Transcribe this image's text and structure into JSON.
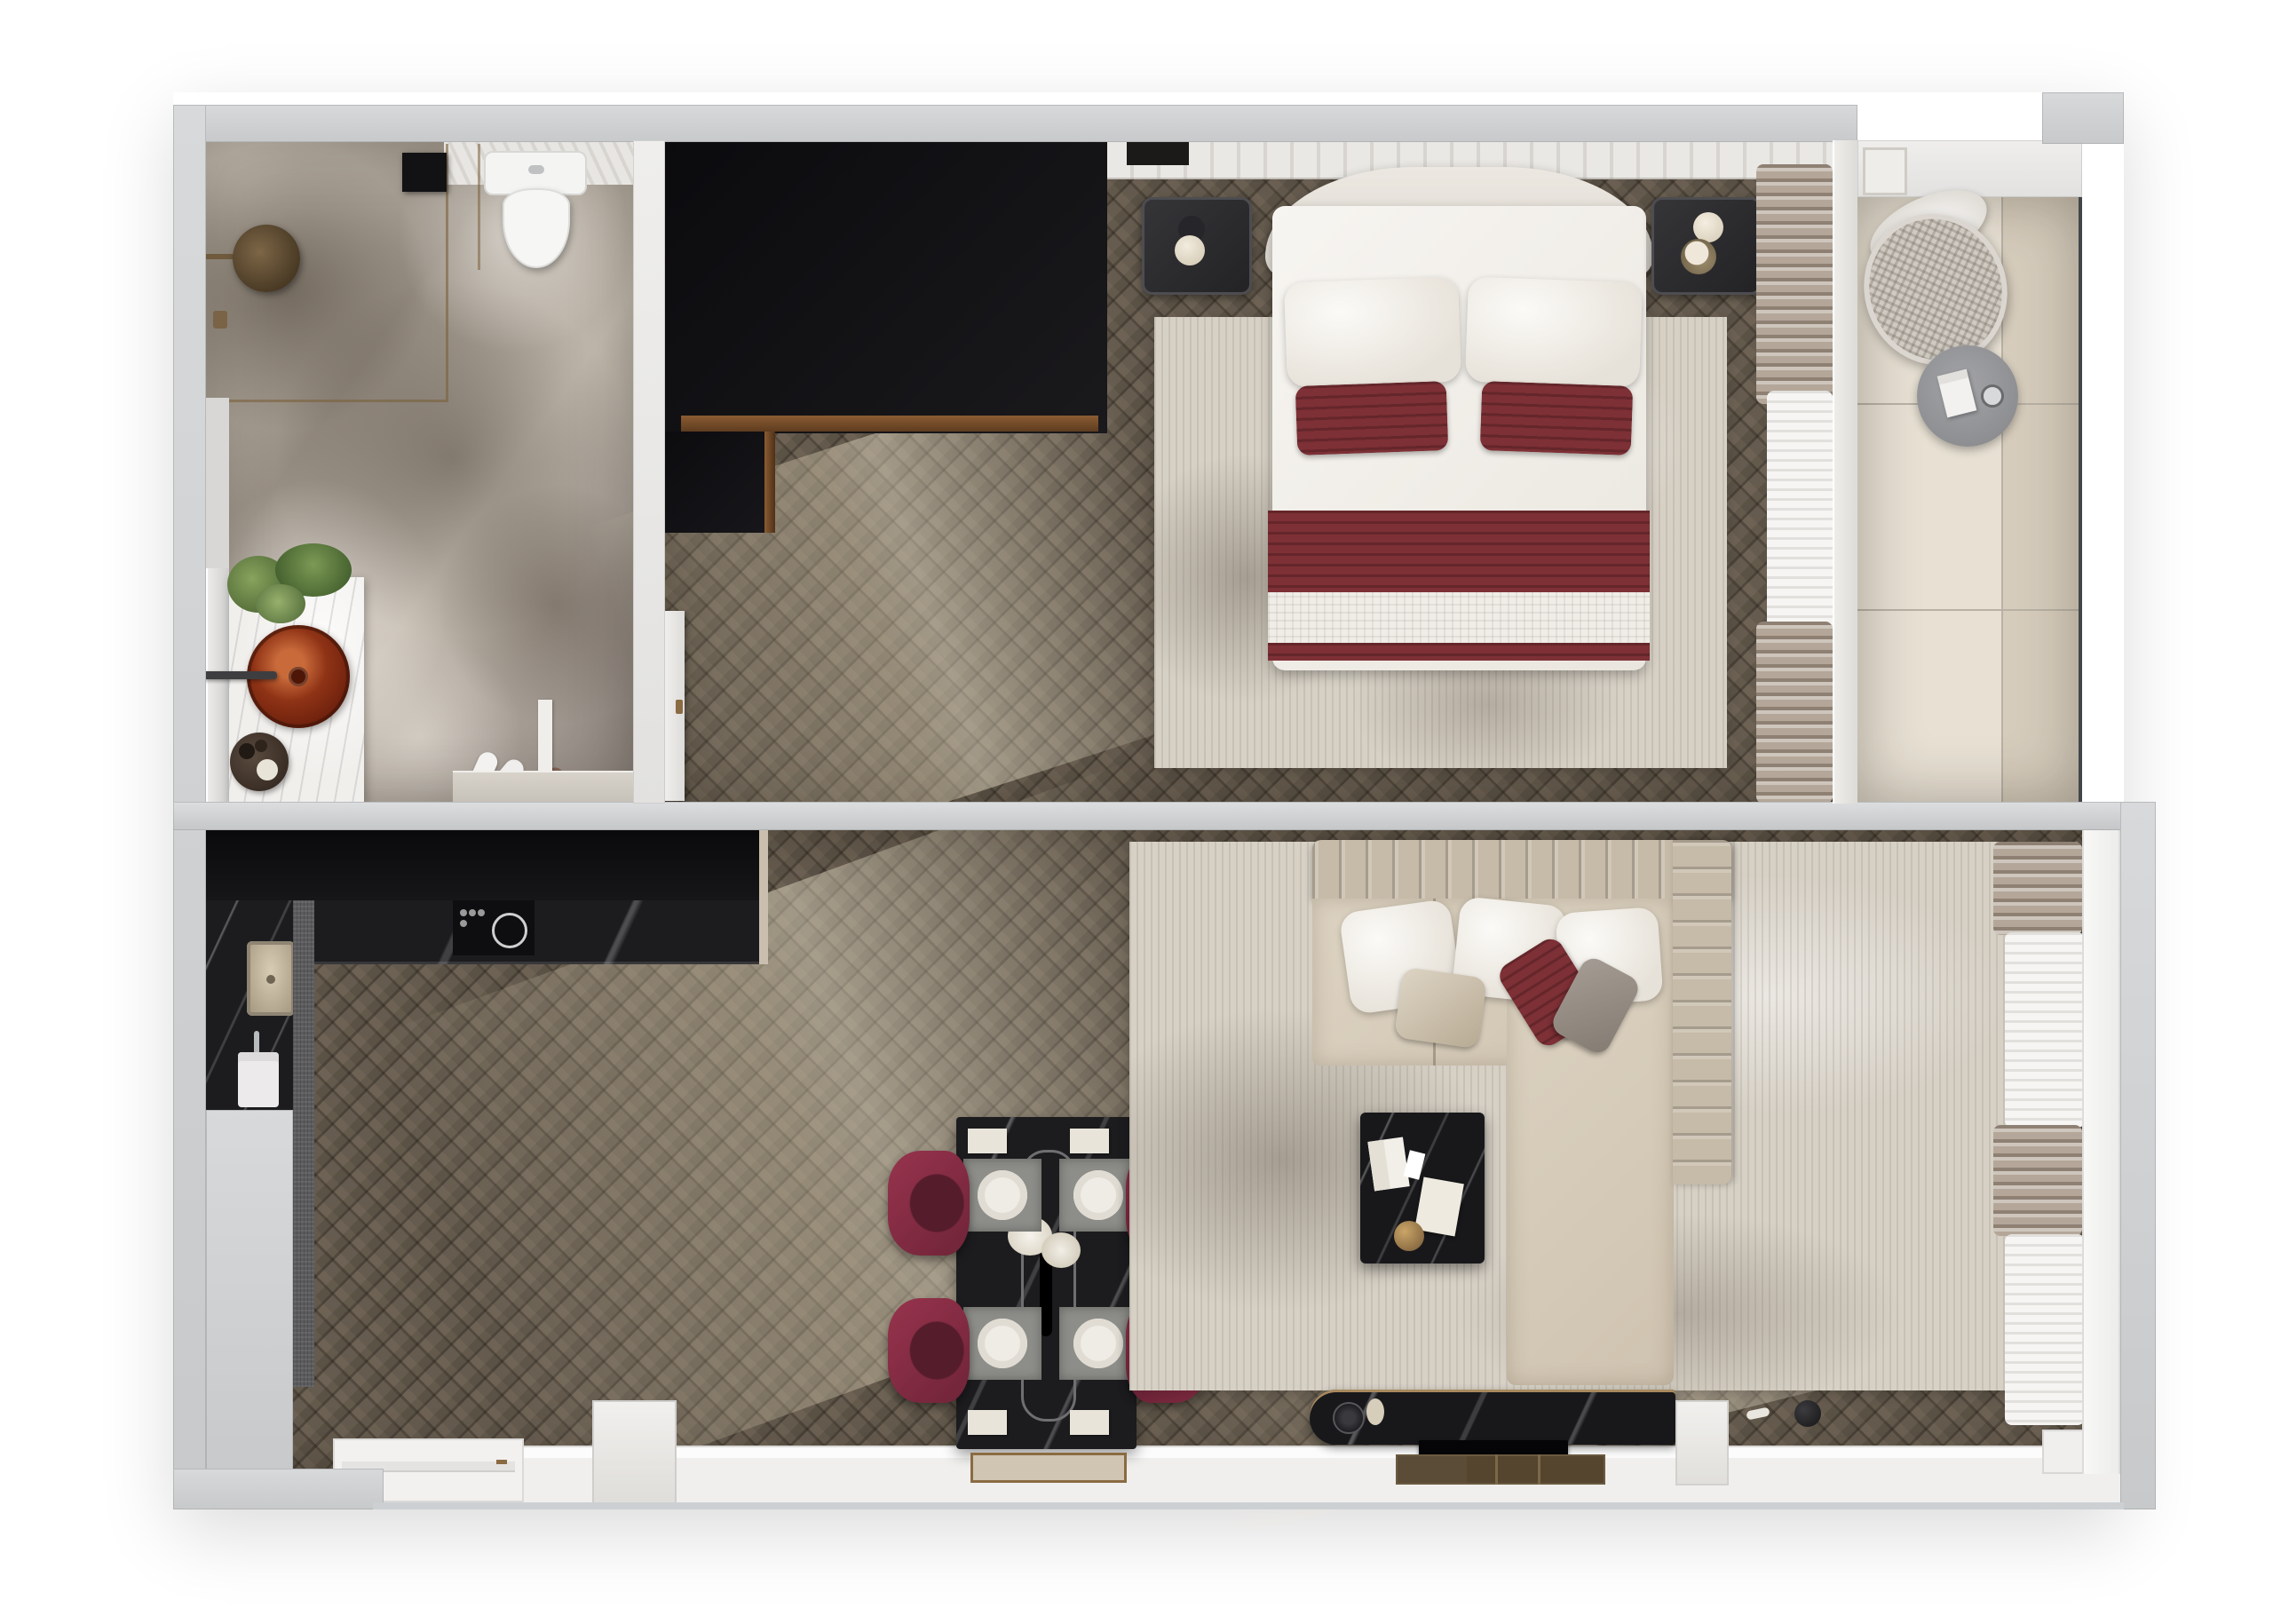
{
  "document": {
    "title": "Apartment 3D Floor Plan — Top-View Render",
    "visible_text": []
  },
  "palette": {
    "background": "#ffffff",
    "wall_gray": "#cdd0d2",
    "wood_dark": "#655b4e",
    "wood_sunlit": "#a2917a",
    "marble_floor": "#b2a99d",
    "black_cabinet": "#0b0b0d",
    "counter_marble": "#1c1c1f",
    "burgundy": "#7d3035",
    "chair_burgundy": "#8e3048",
    "bed_white": "#f4f2ee",
    "headboard": "#e7e3dc",
    "rug": "#d6d0c5",
    "sofa_back": "#c6baa8",
    "sofa_seat": "#d6cbb9",
    "curtain_taupe": "#b4a799",
    "sheer": "#f6f5f3",
    "balcony_tile": "#e7e0d3",
    "balcony_tile_dark": "#d6ccbc",
    "bronze": "#8a6b42",
    "smoked_glass": "#2e2e31",
    "sink_red_glass": "#8f3316",
    "greenery": "#6a8348",
    "fixture_white": "#f4f4f3",
    "console_marble": "#18181b",
    "tv_black": "#050507",
    "wood_mat": "#55452f",
    "railing": "#41464b"
  },
  "rooms": {
    "bathroom": {
      "name": "bathroom",
      "items": [
        "walk-in shower",
        "rain shower head",
        "bronze glass partition",
        "black wall niche",
        "toilet",
        "marble vanity counter",
        "red glass vessel sink",
        "wall-mounted faucet",
        "green plant",
        "round accessory tray",
        "mirror light strip",
        "white slippers",
        "brown slippers",
        "door threshold",
        "door leaf"
      ]
    },
    "bedroom": {
      "name": "bedroom",
      "items": [
        "black L-shaped wardrobe",
        "bronze wardrobe trim",
        "double bed",
        "curved headboard",
        "white pillow x2",
        "burgundy pillow x2",
        "burgundy throw",
        "waffle blanket",
        "distressed area rug",
        "smoked-glass nightstand x2",
        "table lamp decor",
        "taupe drapes",
        "white sheer",
        "entry door leaf",
        "wall trim"
      ]
    },
    "balcony": {
      "name": "balcony",
      "items": [
        "woven lounge chair",
        "white cushion",
        "round gray side table",
        "magazine",
        "cup",
        "glass railing",
        "stone tile floor",
        "balcony door frame"
      ]
    },
    "kitchen": {
      "name": "kitchen",
      "items": [
        "black cabinet run",
        "dark marble countertop",
        "induction cooktop",
        "control knobs",
        "square sink",
        "faucet",
        "appliance front",
        "speckled cabinet side",
        "counter end panel"
      ]
    },
    "dining": {
      "name": "dining area",
      "items": [
        "black marble dining table",
        "oval serving runner",
        "centerpiece flowers",
        "place setting x4",
        "gray placemat x4",
        "napkin x4",
        "burgundy shell chair x4",
        "bronze-framed door mat"
      ]
    },
    "living": {
      "name": "living room",
      "items": [
        "L-shaped channel-tufted sofa",
        "chaise section",
        "white pillow x3",
        "taupe fringe pillow",
        "burgundy pillow",
        "gray pillow",
        "distressed area rug",
        "dark marble coffee table",
        "open book",
        "card",
        "envelope",
        "gold sculpture",
        "marble tv console",
        "speaker decor",
        "tv panel",
        "wood slat mat",
        "taupe drapes",
        "white sheers",
        "window sill"
      ]
    },
    "entry": {
      "name": "entry",
      "items": [
        "entry door recess",
        "bronze door handle",
        "window piers",
        "full-width glazing sill"
      ]
    }
  }
}
